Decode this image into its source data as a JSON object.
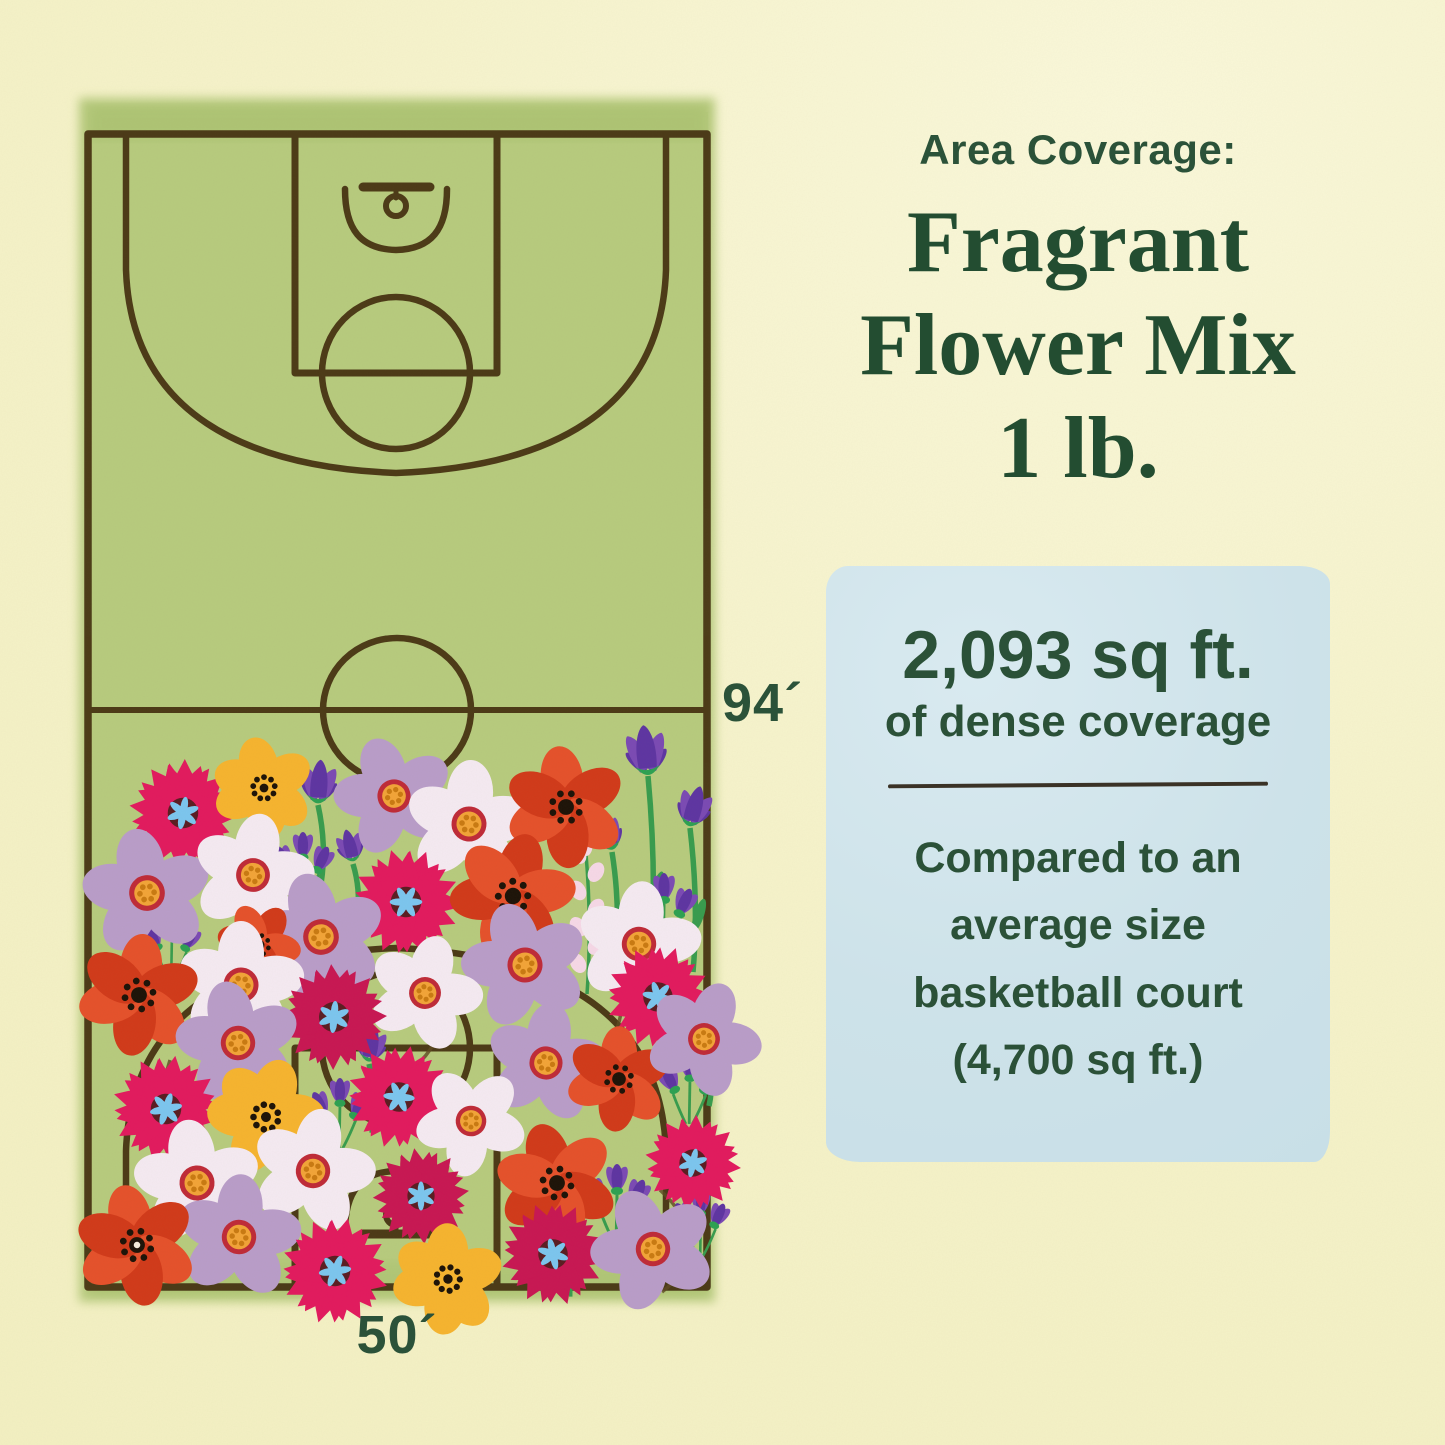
{
  "panel": {
    "heading": "Area Coverage:",
    "product_lines": [
      "Fragrant",
      "Flower Mix",
      "1 lb."
    ],
    "box": {
      "value": "2,093 sq ft.",
      "subtitle": "of dense coverage",
      "comparison_lines": [
        "Compared to an",
        "average size",
        "basketball court",
        "(4,700 sq ft.)"
      ]
    }
  },
  "court": {
    "length_label": "94´",
    "width_label": "50´"
  },
  "colors": {
    "bg": "#f6f3cb",
    "textGreen": "#2b5239",
    "infoBox": "#cde2e9",
    "courtGreen": "#b7cb7e",
    "lineBrown": "#443010",
    "magenta": "#e21a5e",
    "crimson": "#c81753",
    "poppy": "#e5512b",
    "poppyDeep": "#d13a1a",
    "yellowFlower": "#f6b42f",
    "lavender": "#b99dc9",
    "white": "#f5eaf2",
    "purple": "#7b4ab4",
    "purpleDeep": "#5e35a2",
    "stem": "#389c4e",
    "calyx": "#2da152",
    "centerBlue": "#7cc6ef",
    "centerYellow": "#f2a438",
    "ringRed": "#bf2b38",
    "maroon": "#5a1d22",
    "seedBlack": "#1d1308",
    "dotOrange": "#c97a12",
    "spray": "#f6d8e7"
  },
  "flowers": [
    {
      "t": "tulip",
      "x": 648,
      "y": 770,
      "r": 40,
      "a": -6,
      "L": 190
    },
    {
      "t": "tulip",
      "x": 690,
      "y": 822,
      "r": 33,
      "a": 16,
      "L": 150
    },
    {
      "t": "tulip",
      "x": 612,
      "y": 846,
      "r": 29,
      "a": -20,
      "L": 115
    },
    {
      "t": "spray",
      "x": 586,
      "y": 854,
      "a": 0,
      "L": 140
    },
    {
      "t": "tulip",
      "x": 318,
      "y": 799,
      "r": 35,
      "a": 4,
      "L": 85
    },
    {
      "t": "tulip",
      "x": 353,
      "y": 858,
      "r": 26,
      "a": -14,
      "L": 65
    },
    {
      "t": "crocus",
      "x": 302,
      "y": 860,
      "r": 28
    },
    {
      "t": "crocus",
      "x": 663,
      "y": 903,
      "r": 30
    },
    {
      "t": "crocus",
      "x": 171,
      "y": 939,
      "r": 26
    },
    {
      "t": "tulip",
      "x": 369,
      "y": 1058,
      "r": 29,
      "a": 10,
      "L": 75
    },
    {
      "t": "crocus",
      "x": 339,
      "y": 1106,
      "r": 28
    },
    {
      "t": "crocus",
      "x": 689,
      "y": 1081,
      "r": 28
    },
    {
      "t": "spray",
      "x": 561,
      "y": 1172,
      "a": -4,
      "L": 125
    },
    {
      "t": "crocus",
      "x": 616,
      "y": 1194,
      "r": 30
    },
    {
      "t": "crocus",
      "x": 700,
      "y": 1216,
      "r": 26
    },
    {
      "t": "tulip",
      "x": 706,
      "y": 1046,
      "r": 26,
      "a": 20,
      "L": 60
    },
    {
      "t": "cosmos",
      "x": 183,
      "y": 813,
      "r": 56,
      "a": 10,
      "v": "magenta"
    },
    {
      "t": "yellow",
      "x": 264,
      "y": 788,
      "r": 48,
      "a": 0
    },
    {
      "t": "daisy",
      "x": 394,
      "y": 796,
      "r": 52,
      "a": -15,
      "v": "lavender"
    },
    {
      "t": "daisy",
      "x": 469,
      "y": 824,
      "r": 55,
      "a": 8,
      "v": "white"
    },
    {
      "t": "poppy",
      "x": 566,
      "y": 807,
      "r": 58,
      "a": 0,
      "v": "poppy"
    },
    {
      "t": "daisy",
      "x": 147,
      "y": 893,
      "r": 56,
      "a": -6,
      "v": "lavender"
    },
    {
      "t": "daisy",
      "x": 253,
      "y": 875,
      "r": 53,
      "a": 14,
      "v": "white"
    },
    {
      "t": "cosmos",
      "x": 406,
      "y": 902,
      "r": 56,
      "a": 30,
      "v": "magenta"
    },
    {
      "t": "poppy",
      "x": 513,
      "y": 896,
      "r": 60,
      "a": 22,
      "v": "deep"
    },
    {
      "t": "daisy",
      "x": 321,
      "y": 937,
      "r": 56,
      "a": -10,
      "v": "lavender"
    },
    {
      "t": "poppy",
      "x": 259,
      "y": 945,
      "r": 40,
      "a": 40,
      "v": "deep"
    },
    {
      "t": "daisy",
      "x": 241,
      "y": 985,
      "r": 55,
      "a": 6,
      "v": "white"
    },
    {
      "t": "poppy",
      "x": 139,
      "y": 995,
      "r": 58,
      "a": 12,
      "v": "poppy"
    },
    {
      "t": "daisy",
      "x": 525,
      "y": 965,
      "r": 55,
      "a": -14,
      "v": "lavender"
    },
    {
      "t": "daisy",
      "x": 639,
      "y": 944,
      "r": 54,
      "a": 10,
      "v": "white"
    },
    {
      "t": "cosmos",
      "x": 658,
      "y": 997,
      "r": 54,
      "a": -18,
      "v": "magenta"
    },
    {
      "t": "daisy",
      "x": 425,
      "y": 993,
      "r": 50,
      "a": 20,
      "v": "white"
    },
    {
      "t": "cosmos",
      "x": 334,
      "y": 1017,
      "r": 55,
      "a": 5,
      "v": "crimson"
    },
    {
      "t": "daisy",
      "x": 238,
      "y": 1043,
      "r": 54,
      "a": -8,
      "v": "lavender"
    },
    {
      "t": "cosmos",
      "x": 166,
      "y": 1109,
      "r": 56,
      "a": 18,
      "v": "magenta"
    },
    {
      "t": "yellow",
      "x": 266,
      "y": 1117,
      "r": 55,
      "a": 30
    },
    {
      "t": "cosmos",
      "x": 399,
      "y": 1097,
      "r": 54,
      "a": -25,
      "v": "magenta"
    },
    {
      "t": "daisy",
      "x": 546,
      "y": 1063,
      "r": 52,
      "a": 12,
      "v": "lavender"
    },
    {
      "t": "poppy",
      "x": 619,
      "y": 1079,
      "r": 50,
      "a": 8,
      "v": "poppy"
    },
    {
      "t": "daisy",
      "x": 704,
      "y": 1039,
      "r": 50,
      "a": 26,
      "v": "lavender"
    },
    {
      "t": "daisy",
      "x": 197,
      "y": 1183,
      "r": 55,
      "a": -4,
      "v": "white"
    },
    {
      "t": "daisy",
      "x": 313,
      "y": 1171,
      "r": 54,
      "a": 16,
      "v": "white"
    },
    {
      "t": "daisy",
      "x": 471,
      "y": 1121,
      "r": 48,
      "a": -30,
      "v": "white"
    },
    {
      "t": "poppy",
      "x": 557,
      "y": 1183,
      "r": 58,
      "a": -10,
      "v": "deep"
    },
    {
      "t": "cosmos",
      "x": 693,
      "y": 1163,
      "r": 50,
      "a": 12,
      "v": "magenta"
    },
    {
      "t": "cosmos",
      "x": 421,
      "y": 1196,
      "r": 50,
      "a": 0,
      "v": "crimson"
    },
    {
      "t": "daisy",
      "x": 239,
      "y": 1237,
      "r": 54,
      "a": 8,
      "v": "lavender"
    },
    {
      "t": "poppy",
      "x": 137,
      "y": 1245,
      "r": 58,
      "a": -6,
      "v": "poppy",
      "wd": true
    },
    {
      "t": "cosmos",
      "x": 335,
      "y": 1271,
      "r": 56,
      "a": 22,
      "v": "magenta"
    },
    {
      "t": "yellow",
      "x": 448,
      "y": 1279,
      "r": 52,
      "a": 12
    },
    {
      "t": "cosmos",
      "x": 553,
      "y": 1254,
      "r": 54,
      "a": -12,
      "v": "crimson"
    },
    {
      "t": "daisy",
      "x": 653,
      "y": 1249,
      "r": 54,
      "a": -20,
      "v": "lavender"
    }
  ]
}
